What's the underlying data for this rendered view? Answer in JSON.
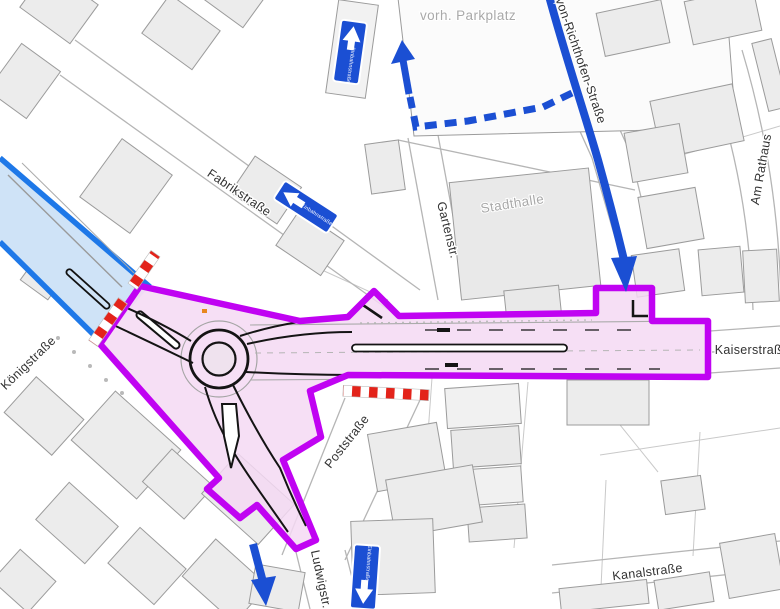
{
  "map": {
    "street_labels": {
      "fabrikstrasse": "Fabrikstraße",
      "gartenstrasse": "Gartenstr.",
      "koenigstrasse": "Königstraße",
      "poststrasse": "Poststraße",
      "ludwigstrasse": "Ludwigstr.",
      "kaiserstrasse": "Kaiserstraße",
      "kanalstrasse": "Kanalstraße",
      "von_richthofen": "von-Richthofen-Straße",
      "am_rathaus": "Am Rathaus"
    },
    "area_labels": {
      "stadthalle": "Stadthalle",
      "parkplatz": "vorh. Parkplatz"
    },
    "signs": {
      "one_way_top": "Einbahnstraße",
      "one_way_fabrik": "Einbahnstraße",
      "one_way_ludwig": "Einbahnstraße"
    },
    "colors": {
      "construction_zone_border": "#c003f2",
      "construction_zone_fill": "#f4d9f3",
      "detour_route_blue": "#1b4fd3",
      "closed_road_fill": "#cfe3f7",
      "closed_road_border": "#1e78e8",
      "closure_barrier_red": "#e3231a",
      "building_fill": "#ececec",
      "building_stroke": "#9b9b9b"
    }
  }
}
